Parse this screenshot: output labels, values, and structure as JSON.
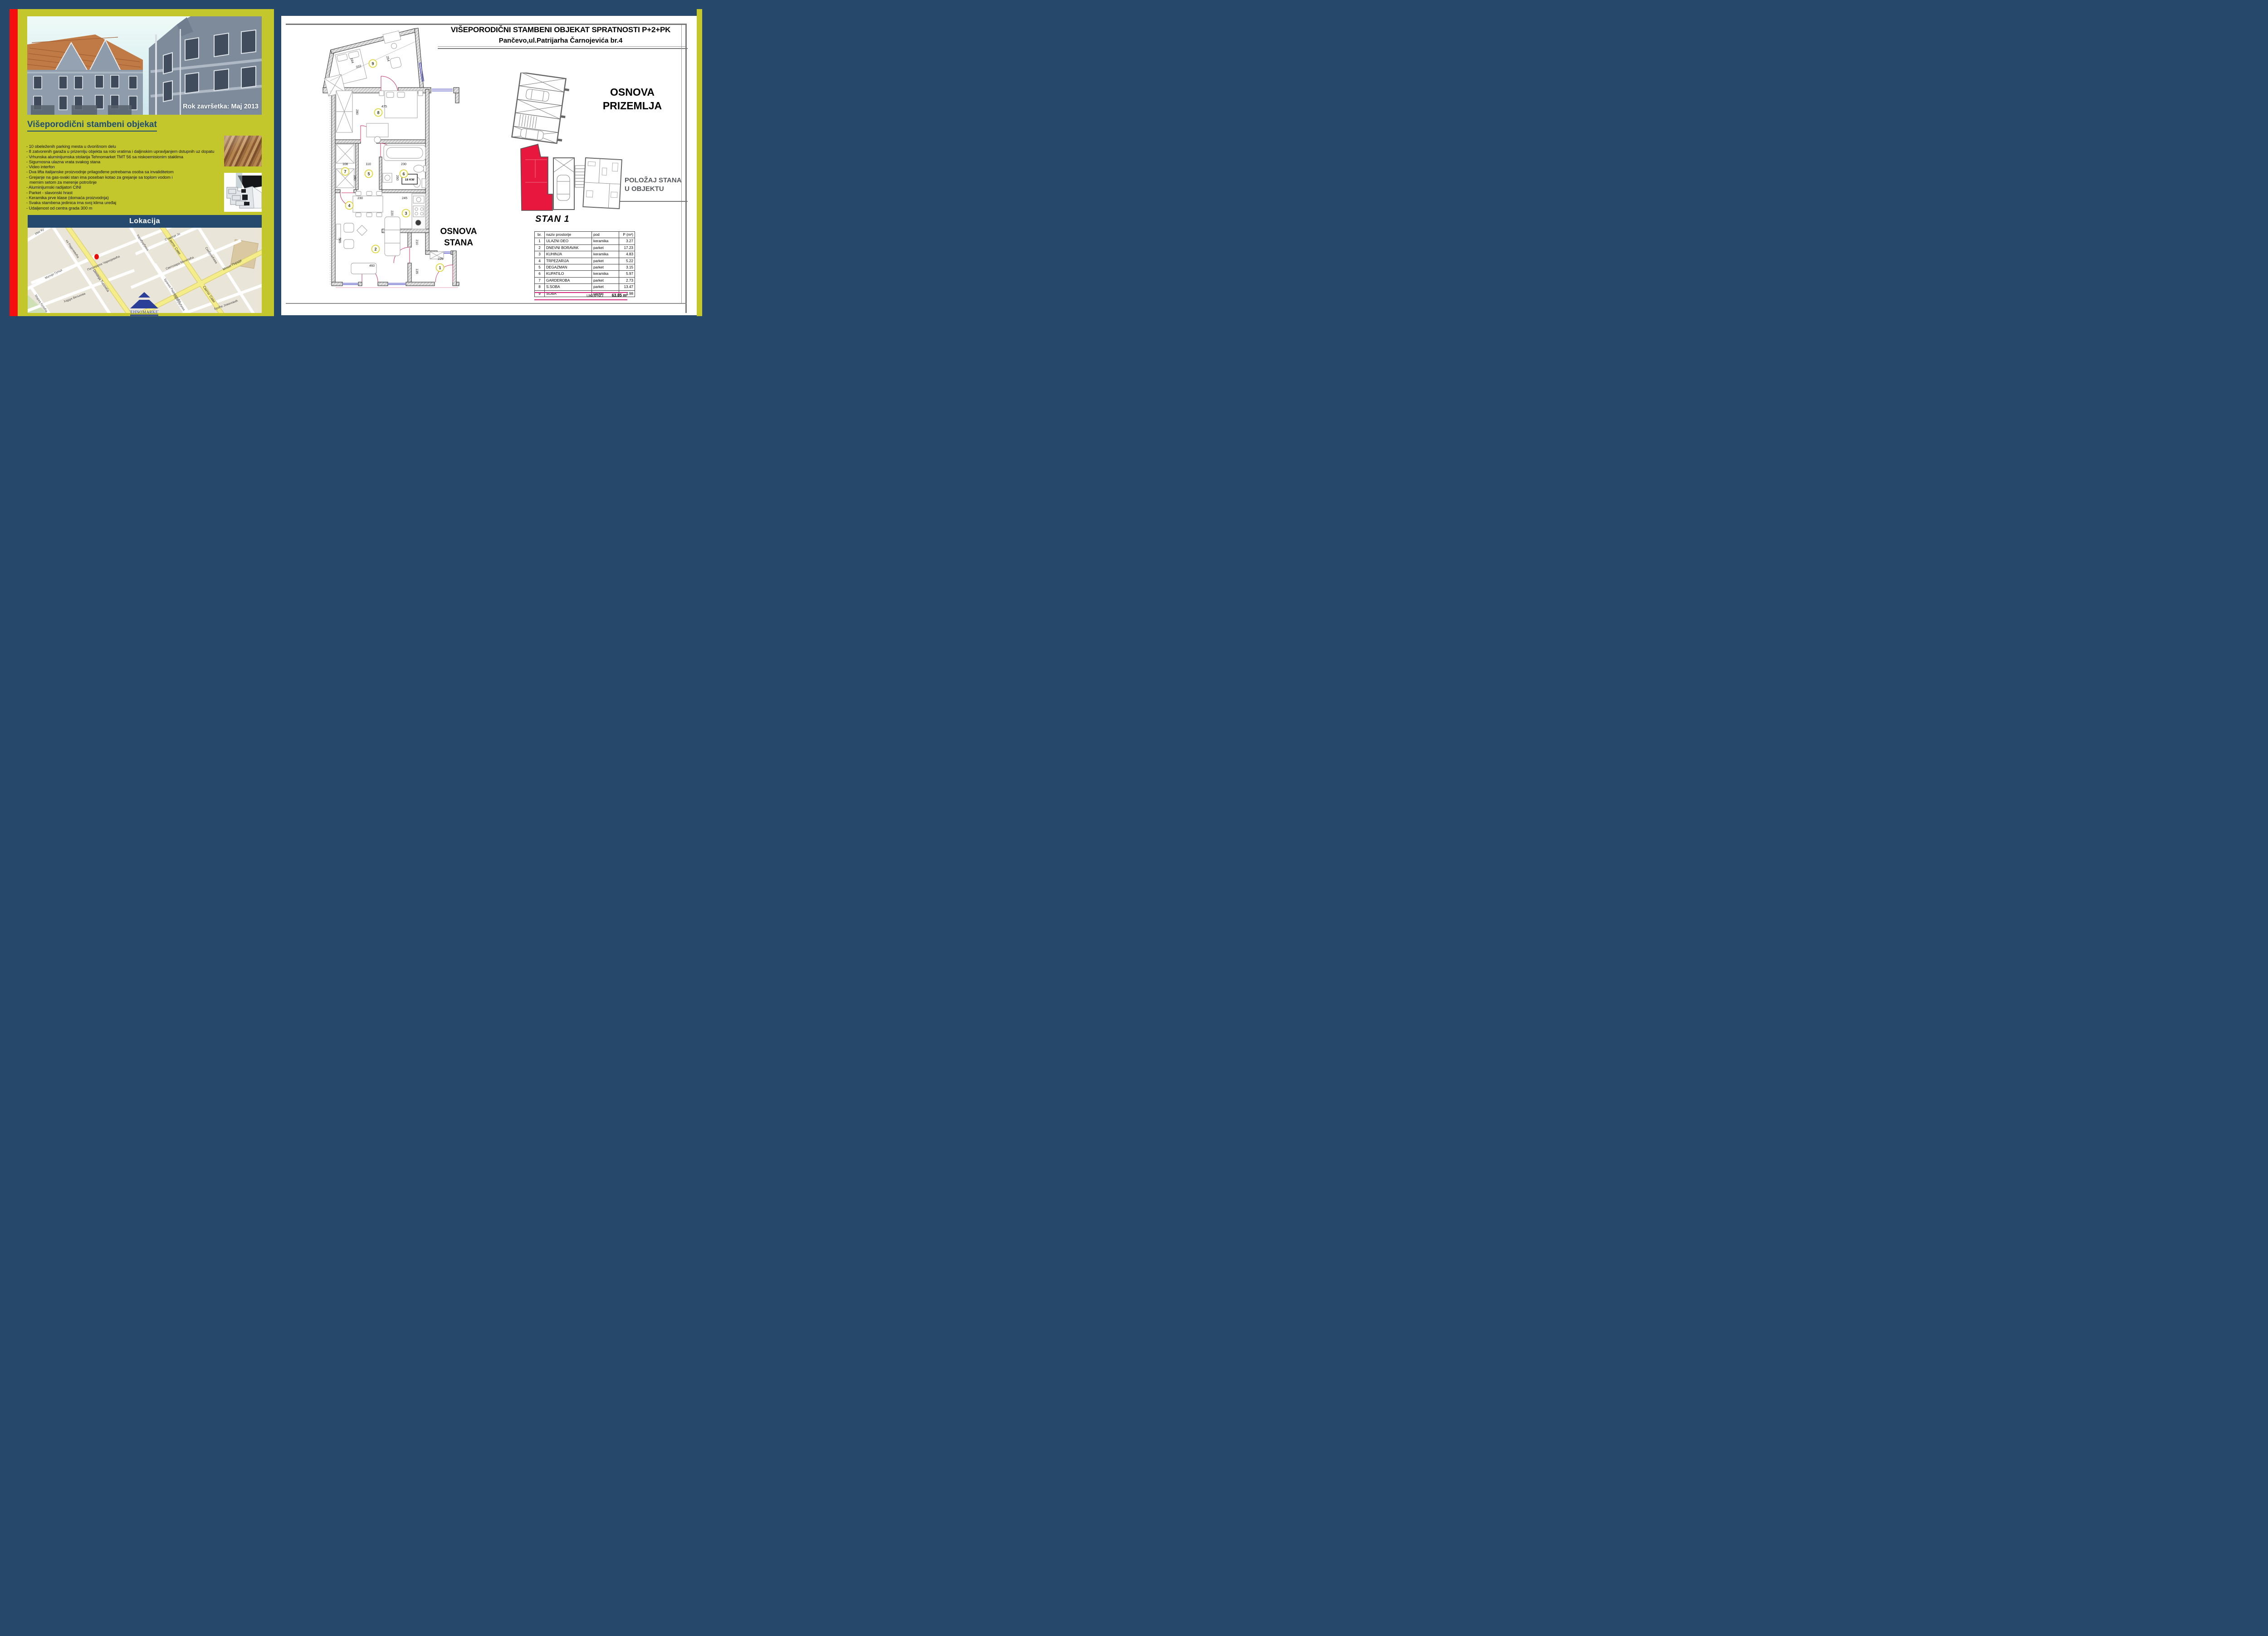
{
  "frame": {
    "border_color": "#26486b",
    "accent_red": "#f60d0d",
    "panel_yellow": "#c4c72c",
    "magenta_rule": "#d6277e",
    "highlight_red_unit": "#e8173d"
  },
  "left": {
    "photo_caption": "Rok završetka: Maj 2013",
    "heading": "Višeporodični stambeni objekat",
    "features": [
      "- 10 obeleženih parking mesta u dvorišnom delu",
      "- 8 zatvorenih garaža u prizemlju objekta sa rolo vratima i daljinskim upravljanjem dstupnih uz dopatu",
      "- Vrhunska aluminijumska stolarija Tehnomarket TMT 56 sa niskoemisionim staklima",
      "- Sigurnosna ulazna vrata svakog stana",
      "- Video interfon",
      "- Dva lifta italijanske proizvodnje prilagođene potrebama osoba sa invaliditetom",
      "- Grejanje na gas-svaki stan ima poseban kotao za grejanje sa toplom vodom i",
      "mernim setom za merenje potrošnje",
      "- Aluminijumski radijatori CINI",
      "- Parket - slavonski hrast",
      "- Keramika prve klase (domaća proizvodnja)",
      "- Svaka stambena jedinica ima svoj klima uređaj",
      "- Udaljenost od centra grada 300 m"
    ],
    "lokacija_title": "Lokacija",
    "map": {
      "streets": [
        "Иве Ку",
        "ка Радичевића",
        "Матије Гупца",
        "Карађорђева",
        "Стевице Јо",
        "Патријарха Чарнојевића",
        "Моше Пијаде",
        "Dimitrija Tucovića",
        "Хајдук Вељкова",
        "Марка Кулића",
        "Бранка Радичевића",
        "Светог Саве",
        "Светозара Милетића",
        "Синђелићева",
        "Светог Саве",
        "Карађорђева",
        "Браће Јовановић"
      ],
      "marker_color": "#e90e0e"
    },
    "logo_text": "TEHNOMARKET"
  },
  "sheet": {
    "title1": "VIŠEPORODIČNI STAMBENI OBJEKAT SPRATNOSTI P+2+PK",
    "title2": "Pančevo,ul.Patrijarha Čarnojevića br.4",
    "plan_label": [
      "OSNOVA",
      "STANA"
    ],
    "site_label": [
      "OSNOVA",
      "PRIZEMLJA"
    ],
    "position_label": [
      "POLOŽAJ STANA",
      "U OBJEKTU"
    ],
    "plan": {
      "rooms": [
        "1",
        "2",
        "3",
        "4",
        "5",
        "6",
        "7",
        "8",
        "9"
      ],
      "dims": [
        "164",
        "332",
        "254",
        "475",
        "280",
        "108",
        "110",
        "230",
        "260",
        "260",
        "230",
        "245",
        "220",
        "585",
        "460",
        "210",
        "135",
        "225"
      ],
      "boiler": "18 KW"
    },
    "table": {
      "title": "STAN 1",
      "headers": [
        "br.",
        "naziv prostorije",
        "pod",
        "P (m²)"
      ],
      "rows": [
        [
          "1",
          "ULAZNI DEO",
          "keramika",
          "3.27"
        ],
        [
          "2",
          "DNEVNI BORAVAK",
          "parket",
          "17.23"
        ],
        [
          "3",
          "KUHINJA",
          "keramika",
          "4.83"
        ],
        [
          "4",
          "TRPEZARIJA",
          "parket",
          "5.22"
        ],
        [
          "5",
          "DEGAZMAN",
          "parket",
          "3.15"
        ],
        [
          "6",
          "KUPATILO",
          "keramika",
          "5.97"
        ],
        [
          "7",
          "GARDEROBA",
          "parket",
          "2.73"
        ],
        [
          "8",
          "S.SOBA",
          "parket",
          "13.47"
        ],
        [
          "9",
          "SOBA",
          "parket",
          "7.98"
        ]
      ],
      "total_label": "UKUPNO",
      "total_value": "63.85 m²"
    }
  }
}
